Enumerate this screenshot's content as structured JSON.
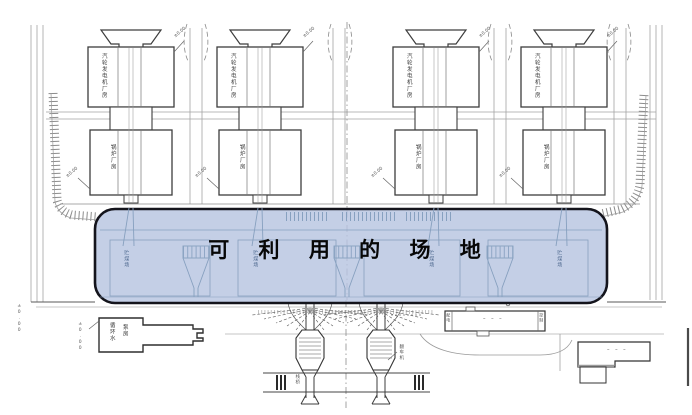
{
  "site": {
    "title": "可 利 用 的 场 地"
  },
  "units": [
    {
      "upper": "汽轮发电机厂房",
      "lower": "锅炉厂房",
      "elev_top": "±0.00",
      "elev_bot": "±0.00",
      "yard": "贮煤场"
    },
    {
      "upper": "汽轮发电机厂房",
      "lower": "锅炉厂房",
      "elev_top": "±0.00",
      "elev_bot": "±0.00",
      "yard": "贮煤场"
    },
    {
      "upper": "汽轮发电机厂房",
      "lower": "锅炉厂房",
      "elev_top": "±0.00",
      "elev_bot": "±0.00",
      "yard": "贮煤场"
    },
    {
      "upper": "汽轮发电机厂房",
      "lower": "锅炉厂房",
      "elev_top": "±0.00",
      "elev_bot": "±0.00",
      "yard": "贮煤场"
    }
  ],
  "labels": {
    "pump_col1": "循环水",
    "pump_col2": "泵房",
    "pump_elev": "±0.00",
    "boundary_elev": "±0.00",
    "jetty_left": "栈桥",
    "jetty_right": "翻车机",
    "workshop_marks": "– – –",
    "workshop_end_left": "配电",
    "workshop_end_right": "控制",
    "storage_marks": "– – –"
  },
  "colors": {
    "highlight_fill": "#b7c5e0",
    "highlight_border": "#14141c",
    "building_line": "#3d3d3d",
    "band_line": "#87a0bf",
    "road_line": "#a3a3a3"
  }
}
